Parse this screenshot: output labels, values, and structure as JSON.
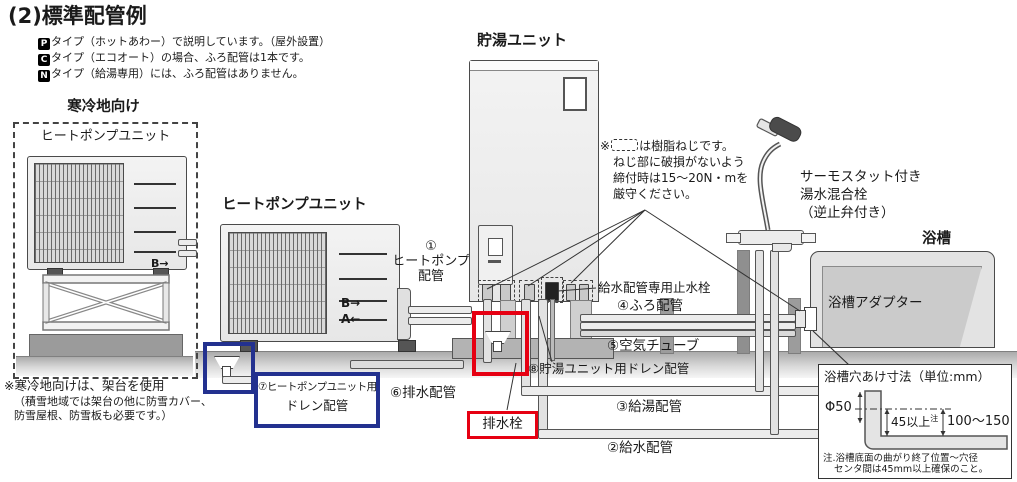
{
  "page": {
    "title": "(2)標準配管例"
  },
  "type_notes": [
    {
      "badge": "P",
      "text": "タイプ（ホットあわー）で説明しています。（屋外設置）"
    },
    {
      "badge": "C",
      "text": "タイプ（エコオート）の場合、ふろ配管は1本です。"
    },
    {
      "badge": "N",
      "text": "タイプ（給湯専用）には、ふろ配管はありません。"
    }
  ],
  "cold_region": {
    "title": "寒冷地向け",
    "unit_label": "ヒートポンプユニット",
    "port_b": "B→",
    "port_a": "A←",
    "note1": "※寒冷地向けは、架台を使用",
    "note2": "（積雪地域では架台の他に防雪カバー、",
    "note3": "防雪屋根、防雪板も必要です。）"
  },
  "heat_pump": {
    "label": "ヒートポンプユニット",
    "port_b": "B→",
    "port_a": "A←"
  },
  "tank_label": "貯湯ユニット",
  "resin_note": {
    "line1_pre": "※",
    "line1_post": "は樹脂ねじです。",
    "line2": "ねじ部に破損がないよう",
    "line3": "締付時は15～20N・mを",
    "line4": "厳守ください。"
  },
  "pipe_labels": {
    "p1_num": "①",
    "p1_a": "ヒートポンプ",
    "p1_b": "配管",
    "p2": "②給水配管",
    "p3": "③給湯配管",
    "p4": "④ふろ配管",
    "p5": "⑤空気チューブ",
    "p6": "⑥排水配管",
    "p7_a": "⑦ヒートポンプユニット用",
    "p7_b": "ドレン配管",
    "p8": "⑧貯湯ユニット用ドレン配管",
    "stop_valve": "給水配管専用止水栓",
    "drain_plug": "排水栓"
  },
  "bath": {
    "mixer1": "サーモスタット付き",
    "mixer2": "湯水混合栓",
    "mixer3": "（逆止弁付き）",
    "tub": "浴槽",
    "adapter": "浴槽アダプター"
  },
  "dim_box": {
    "title": "浴槽穴あけ寸法（単位:mm）",
    "dia": "Φ50",
    "d45": "45以上",
    "d45_sup": "注",
    "d100": "100～150",
    "note1": "注.浴槽底面の曲がり終了位置～穴径",
    "note2": "センタ間は45mm以上確保のこと。"
  },
  "colors": {
    "highlight_red": "#e60012",
    "highlight_blue": "#23318f"
  }
}
